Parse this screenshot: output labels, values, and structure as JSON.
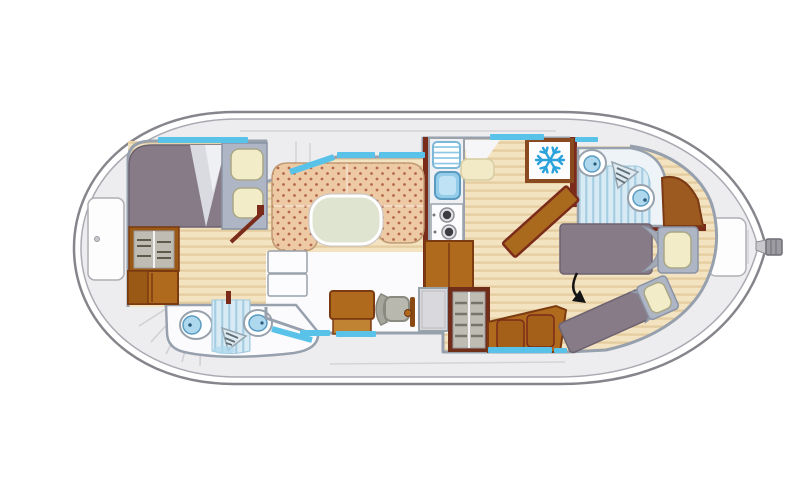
{
  "meta": {
    "description": "Top-down boat floor plan (canal cruiser), no visible text labels",
    "canvas": {
      "width": 810,
      "height": 500
    }
  },
  "icons": {
    "freezer": "snowflake",
    "front_shower": "shower-head",
    "aft_shower": "shower-head",
    "front_toilet": "toilet-bowl",
    "aft_toilet": "toilet-bowl",
    "front_sink": "washbasin",
    "aft_sink": "washbasin",
    "helm": "steering-lever",
    "bow_stairs": "fan-steps",
    "bed_arrow": "curved-arrow"
  },
  "palette": {
    "hull_stroke": "#85858b",
    "hull_inner_stroke": "#aaaab2",
    "deck": "#ededf0",
    "deck_line": "#d3d3d8",
    "wall": "#97a0ad",
    "wall_dark": "#7b2b1a",
    "wood_frame": "#7b3a10",
    "wood_light": "#f4e3c0",
    "wood_stripe": "#e4cc9f",
    "brown": "#b06a1e",
    "sofa_base": "#edcaa4",
    "sofa_dot": "#b5684a",
    "sofa_edge": "#c09a72",
    "table": "#dfe4d1",
    "bed": "#867b87",
    "bed_edge": "#6d6370",
    "fold": "#d9dbe0",
    "pillow": "#f3ecc9",
    "panel": "#aeb6c6",
    "window": "#58c2e9",
    "fixture_edge": "#98a2ac",
    "water": "#aed8ee",
    "water_deep": "#5b9bc0",
    "shower_base": "#d8eaf4",
    "shower_stripe": "#a5cde2",
    "drain_stripe": "#8ec8e6",
    "snow": "#2aa2db",
    "steel_edge": "#9aa2ac",
    "burner": "#3c3c42",
    "seat": "#b9b8ae",
    "seat_edge": "#8a8a80",
    "white_room": "#fbfbfd",
    "bath_floor": "#eef3f7",
    "arrow": "#141414"
  }
}
